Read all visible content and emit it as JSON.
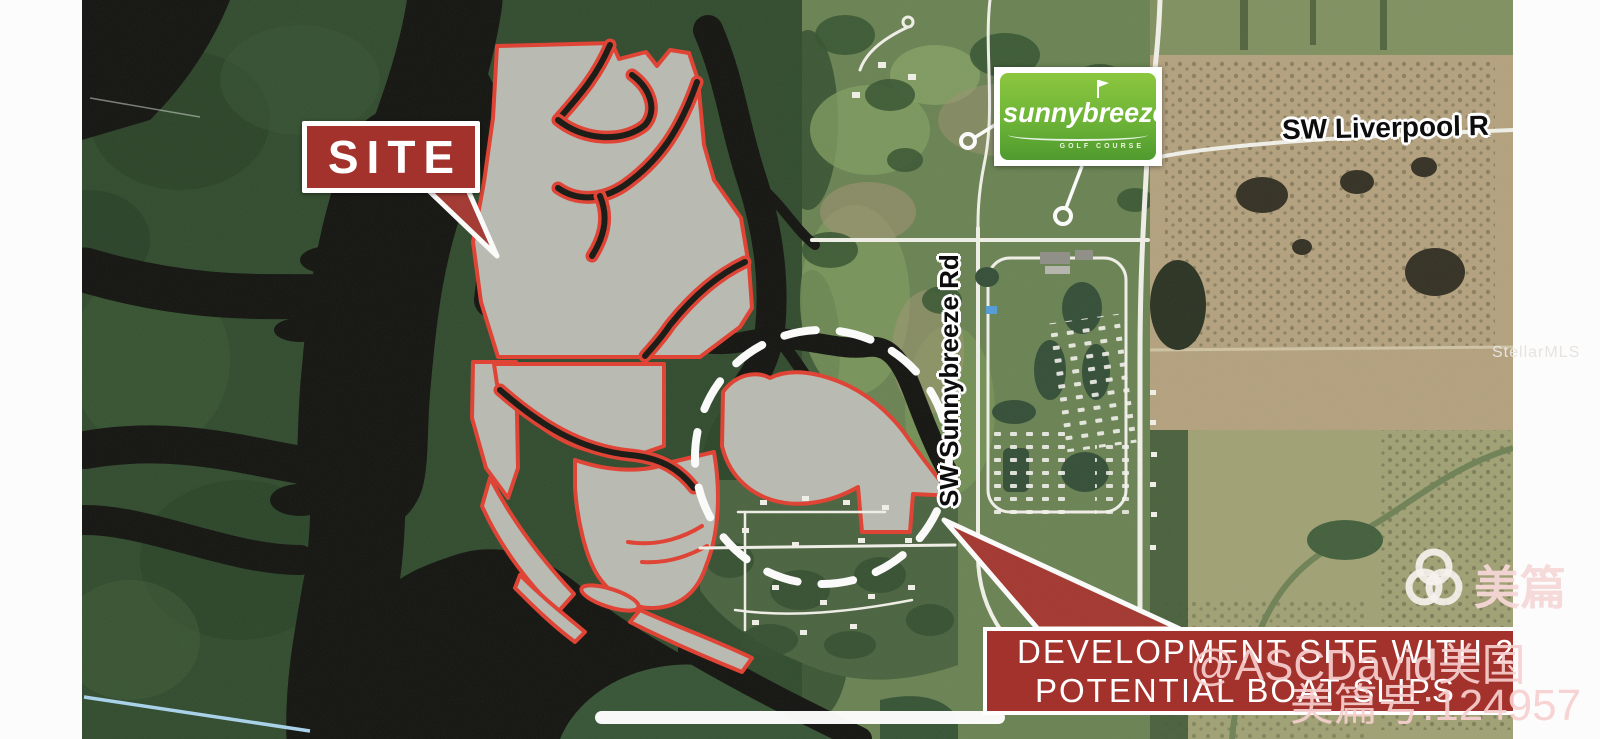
{
  "colors": {
    "banner-red": "#a2322b",
    "site-red": "#e23b2c",
    "scrub": "#b9bab1",
    "logo-green-light": "#8cc63f",
    "logo-green-dark": "#4f9a2f",
    "water": "#0d0d0a",
    "forest": "#2c4729",
    "farmland": "#b3a07c",
    "road": "#f2f1ea",
    "dashed": "#ffffff"
  },
  "callout": {
    "site_label": "SITE"
  },
  "logo": {
    "title": "sunnybreeze",
    "subtitle": "GOLF COURSE"
  },
  "roads": {
    "liverpool_label": "SW Liverpool R",
    "sunnybreeze_label": "SW Sunnybreeze Rd"
  },
  "banner": {
    "line1": "DEVELOPMENT SITE WITH 23",
    "line2": "POTENTIAL BOAT SLIPS"
  },
  "watermarks": {
    "mls": "StellarMLS",
    "meipian": "美篇",
    "author_overlay": "@ASCDavid美国",
    "meipian_id_overlay": "美篇号:124957"
  }
}
